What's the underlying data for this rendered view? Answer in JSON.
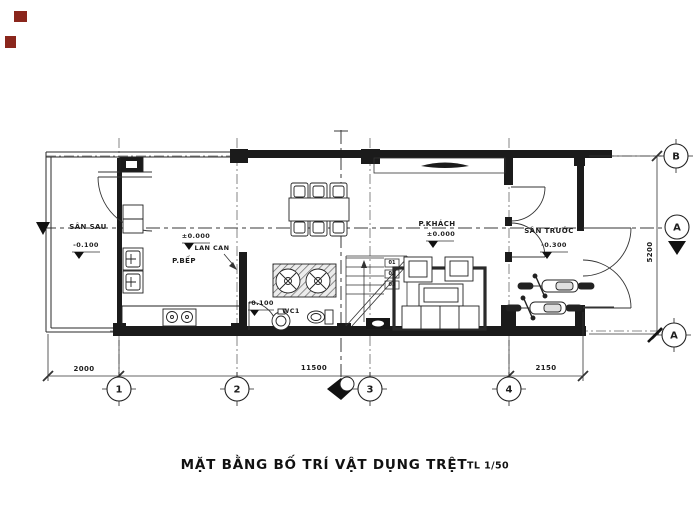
{
  "title": {
    "text": "MẶT BẰNG BỐ TRÍ VẬT DỤNG TRỆT",
    "scale": "TL 1/50"
  },
  "rooms": {
    "san_sau": {
      "label": "SÂN SAU",
      "level": "-0.100"
    },
    "bep": {
      "label": "P.BẾP",
      "level": "±0.000"
    },
    "wc": {
      "label": "WC1",
      "level": "-0.100"
    },
    "khach": {
      "label": "P.KHÁCH",
      "level": "±0.000"
    },
    "san_truoc": {
      "label": "SÂN TRƯỚC",
      "level": "-0.300"
    }
  },
  "annotations": {
    "lan_can": "LAN CAN"
  },
  "grid": {
    "col_1": "1",
    "col_2": "2",
    "col_3": "3",
    "col_4": "4",
    "row_b": "B",
    "row_a": "A",
    "section": "A"
  },
  "dimensions": {
    "back_yard": "2000",
    "house": "11500",
    "front_yard": "2150",
    "width": "5200"
  },
  "stairs": {
    "steps": [
      "01",
      "02",
      "03"
    ]
  },
  "colors": {
    "line": "#1b1b1b",
    "mark": "#8a261c"
  }
}
